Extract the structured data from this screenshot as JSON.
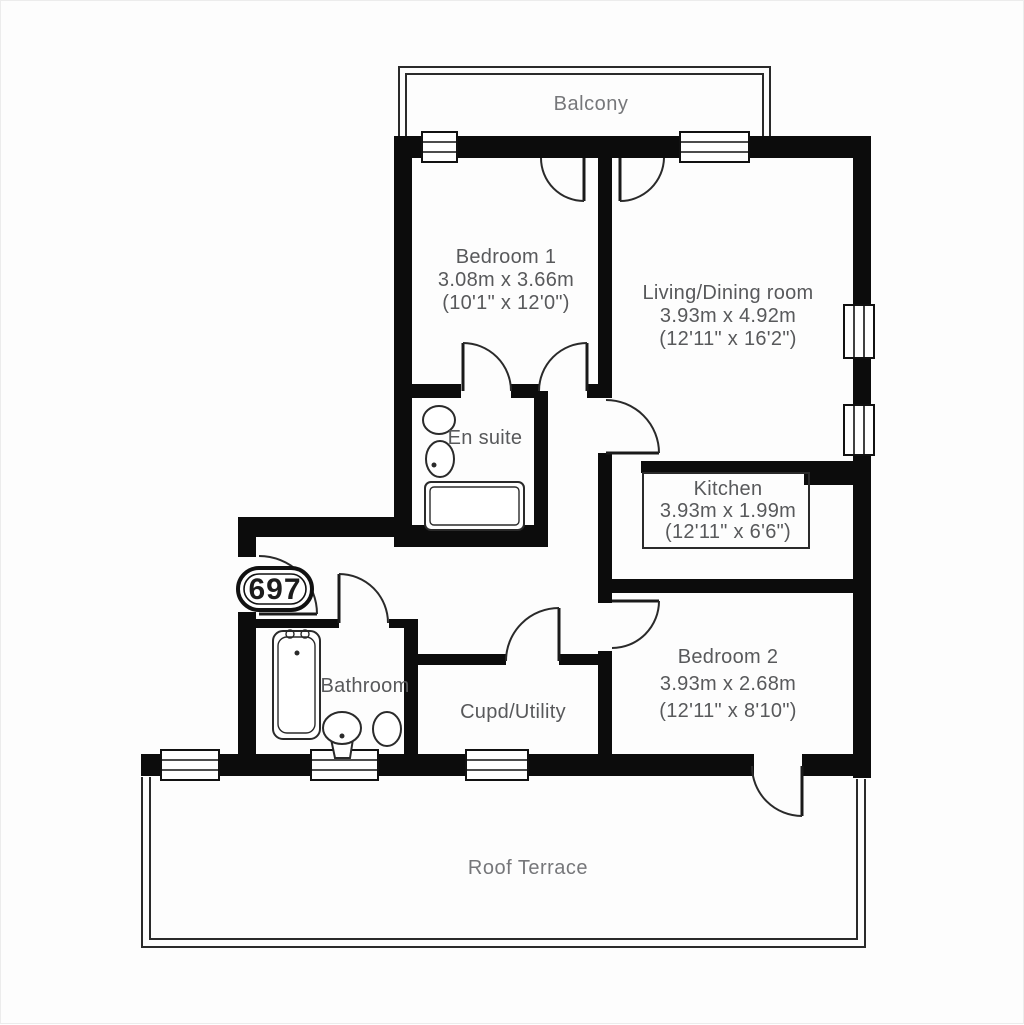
{
  "plan": {
    "unit_number": "697",
    "rooms": {
      "balcony": {
        "name": "Balcony"
      },
      "bedroom1": {
        "name": "Bedroom 1",
        "metric": "3.08m x 3.66m",
        "imperial": "(10'1\" x 12'0\")"
      },
      "living": {
        "name": "Living/Dining room",
        "metric": "3.93m x 4.92m",
        "imperial": "(12'11\" x 16'2\")"
      },
      "ensuite": {
        "name": "En suite"
      },
      "kitchen": {
        "name": "Kitchen",
        "metric": "3.93m x 1.99m",
        "imperial": "(12'11\" x 6'6\")"
      },
      "bathroom": {
        "name": "Bathroom"
      },
      "cupd": {
        "name": "Cupd/Utility"
      },
      "bedroom2": {
        "name": "Bedroom 2",
        "metric": "3.93m x 2.68m",
        "imperial": "(12'11\" x 8'10\")"
      },
      "terrace": {
        "name": "Roof Terrace"
      }
    },
    "colors": {
      "wall": "#0c0c0c",
      "room_text": "#58595b",
      "outdoor_text": "#76777a",
      "line": "#2a2a2a",
      "background": "#fdfdfd"
    }
  }
}
